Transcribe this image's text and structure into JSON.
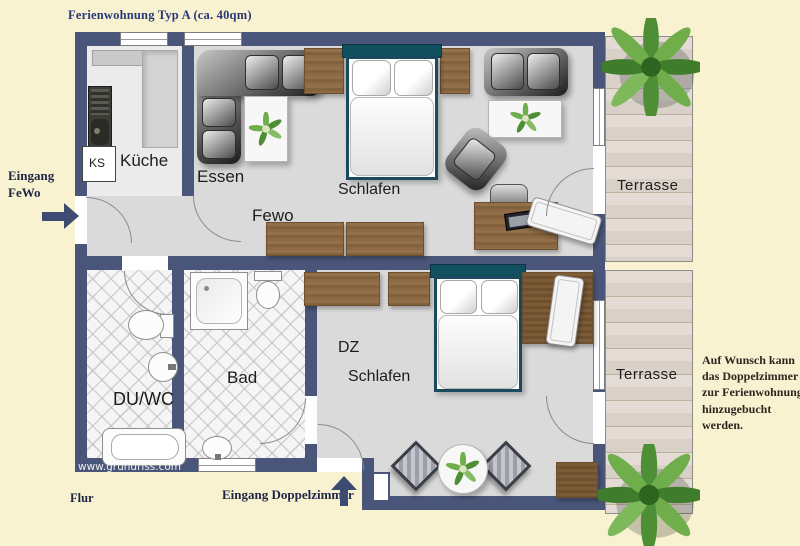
{
  "title": "Ferienwohnung Typ A (ca. 40qm)",
  "labels": {
    "kueche": "Küche",
    "ks": "KS",
    "essen": "Essen",
    "fewo": "Fewo",
    "schlafen_fewo": "Schlafen",
    "terrasse_top": "Terrasse",
    "du_wc": "DU/WC",
    "bad": "Bad",
    "dz": "DZ",
    "schlafen_dz": "Schlafen",
    "terrasse_bottom": "Terrasse"
  },
  "annotations": {
    "eingang_fewo_line1": "Eingang",
    "eingang_fewo_line2": "FeWo",
    "eingang_doppelzimmer": "Eingang Doppelzimmer",
    "flur": "Flur",
    "note": "Auf Wunsch kann das Doppelzimmer zur Ferienwohnung hinzugebucht werden.",
    "watermark": "www.grundriss.com"
  },
  "colors": {
    "background": "#f8f2d0",
    "wall": "#4a5679",
    "floor": "#dadada",
    "tile_floor": "#f5f5f5",
    "terrace_floor": "#ddd4cc",
    "wood": "#8a6a43",
    "bed_frame": "#1b4a5e",
    "title_text": "#293879",
    "annotation_text": "#1e2545",
    "plant_green": "#4e8f35"
  }
}
